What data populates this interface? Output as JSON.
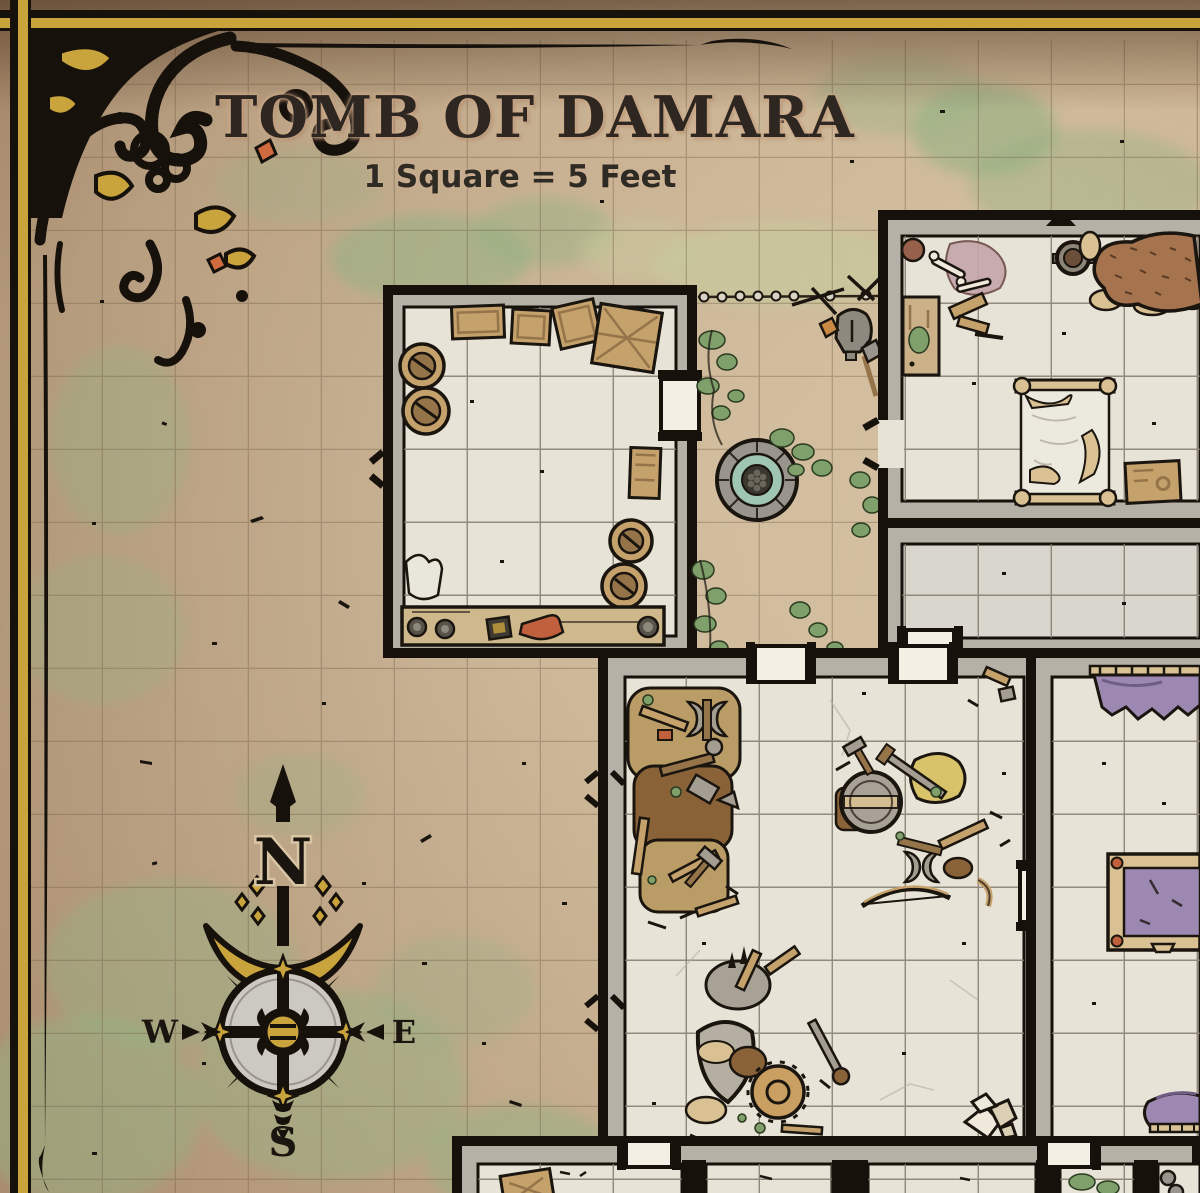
{
  "map": {
    "title": "Tomb of Damara",
    "scale_label": "1 Square = 5 Feet",
    "grid": {
      "square_feet": 5,
      "cell_px": 73
    },
    "compass": {
      "north": "N",
      "east": "E",
      "south": "S",
      "west": "W"
    },
    "colors": {
      "parchment": "#d7c4a3",
      "parchment_edge": "#c2a288",
      "moss": "#94b183",
      "grass": "#c8c79c",
      "floor": "#e8e3d7",
      "floor_dark": "#d9d6ce",
      "wall_ink": "#17110c",
      "wall_stone": "#b6b1a6",
      "gold": "#c9a33b",
      "wood": "#c5a16c",
      "wood_dark": "#96744a",
      "wood_light": "#d9c193",
      "purple": "#9d88b2",
      "fur": "#a5744e",
      "water": "#9fc5b3",
      "door": "#f3efe5",
      "ink": "#1b150f",
      "red": "#c0603c"
    },
    "rooms": [
      {
        "id": "storage-room",
        "contents": [
          "crates",
          "large-crate",
          "barrels",
          "cabinet",
          "workbench",
          "sack",
          "boot",
          "coils"
        ]
      },
      {
        "id": "courtyard",
        "contents": [
          "stone-well",
          "vines",
          "chain-fence",
          "helmet",
          "shovel",
          "broken-sticks"
        ]
      },
      {
        "id": "bedchamber",
        "contents": [
          "bed",
          "fur-carpet",
          "brazier-bowl",
          "bench",
          "bones",
          "remains",
          "small-crate"
        ]
      },
      {
        "id": "empty-corridor-room",
        "contents": []
      },
      {
        "id": "great-hall",
        "contents": [
          "debris-pile-west",
          "debris-pile-center",
          "debris-pile-south",
          "rock-pile"
        ]
      },
      {
        "id": "purple-chamber",
        "contents": [
          "wall-banner",
          "purple-divan",
          "draped-cloth-rack"
        ]
      },
      {
        "id": "south-cells",
        "contents": [
          "wooden-box",
          "moss-patch",
          "stone-orbs"
        ]
      }
    ],
    "legend": {
      "doors": "white blocks in walls",
      "grid": "1 square = 5 feet"
    }
  }
}
